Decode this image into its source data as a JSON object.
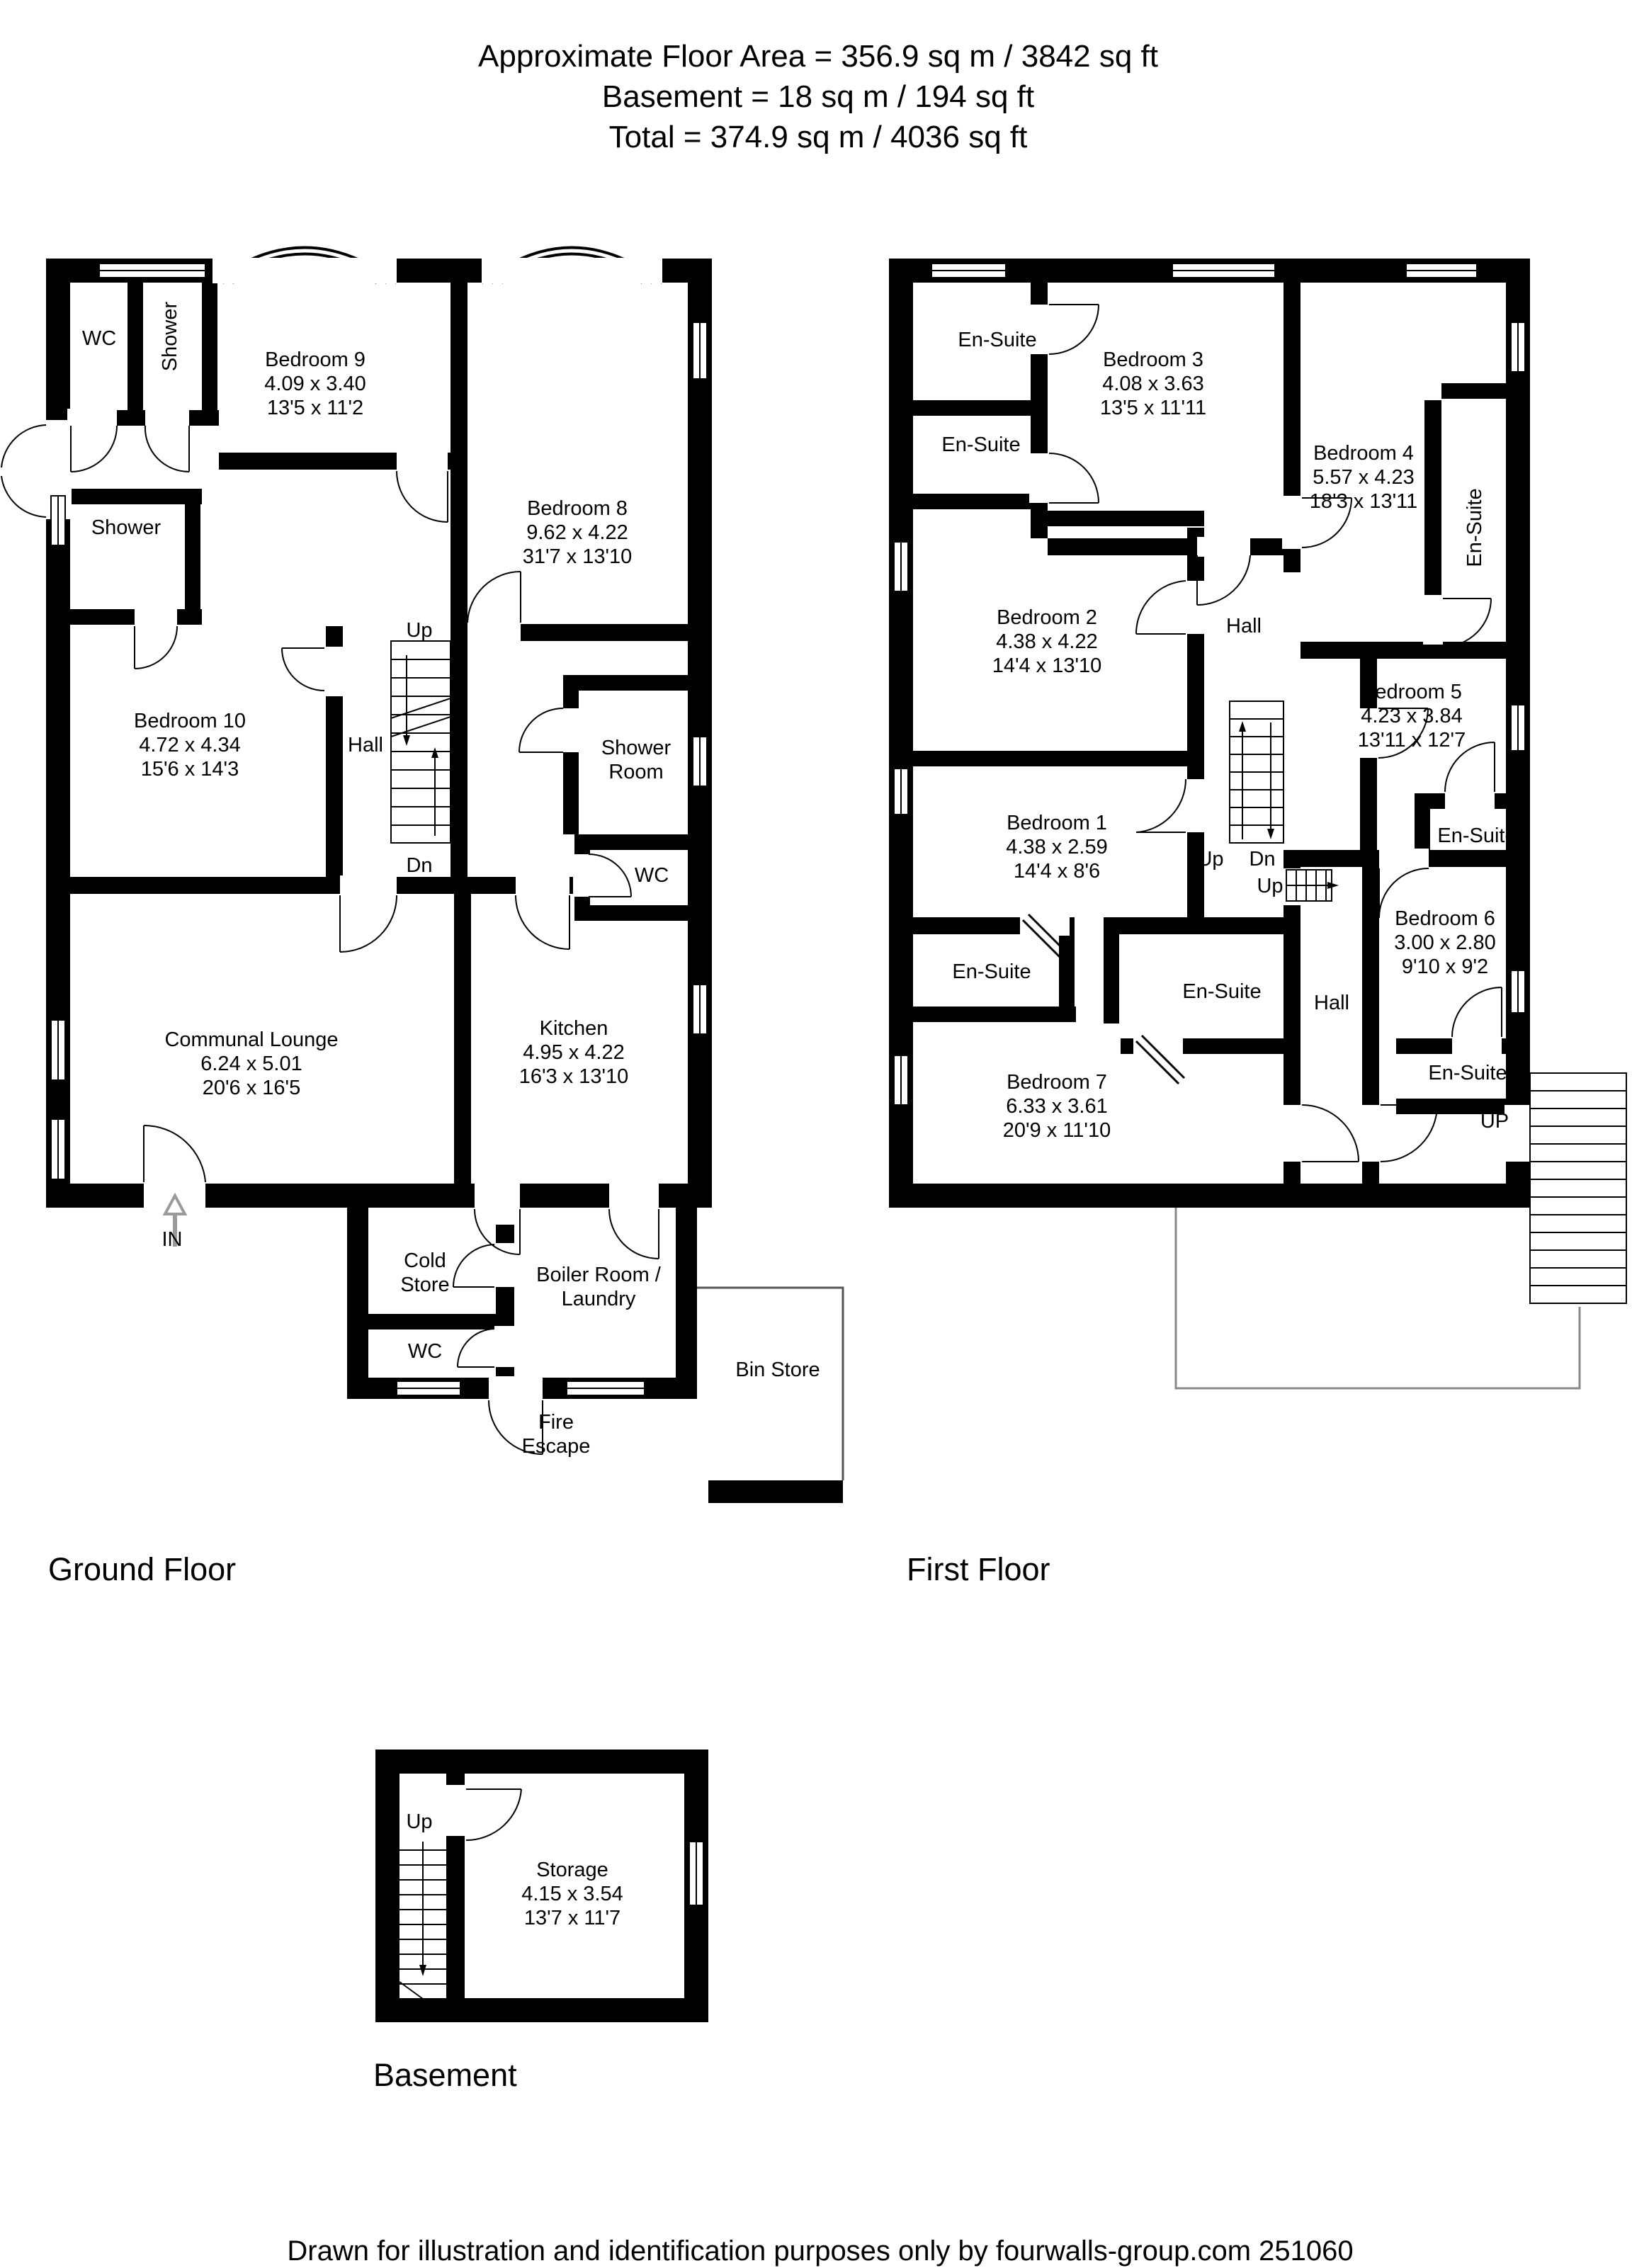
{
  "header": {
    "line1": "Approximate Floor Area = 356.9 sq m / 3842 sq ft",
    "line2": "Basement = 18 sq m / 194 sq ft",
    "line3": "Total = 374.9 sq m / 4036 sq ft"
  },
  "floors": {
    "ground": {
      "label": "Ground Floor",
      "rooms": {
        "wc_top": {
          "name": "WC"
        },
        "shower_top": {
          "name": "Shower"
        },
        "bedroom9": {
          "name": "Bedroom 9",
          "metric": "4.09 x 3.40",
          "imperial": "13'5 x 11'2"
        },
        "bedroom8": {
          "name": "Bedroom 8",
          "metric": "9.62 x 4.22",
          "imperial": "31'7 x 13'10"
        },
        "shower_mid": {
          "name": "Shower"
        },
        "bedroom10": {
          "name": "Bedroom 10",
          "metric": "4.72 x 4.34",
          "imperial": "15'6 x 14'3"
        },
        "hall": {
          "name": "Hall"
        },
        "shower_room": {
          "line1": "Shower",
          "line2": "Room"
        },
        "wc_right": {
          "name": "WC"
        },
        "communal_lounge": {
          "name": "Communal Lounge",
          "metric": "6.24 x 5.01",
          "imperial": "20'6 x 16'5"
        },
        "kitchen": {
          "name": "Kitchen",
          "metric": "4.95 x 4.22",
          "imperial": "16'3 x 13'10"
        },
        "cold_store": {
          "line1": "Cold",
          "line2": "Store"
        },
        "wc_bottom": {
          "name": "WC"
        },
        "boiler": {
          "line1": "Boiler Room /",
          "line2": "Laundry"
        },
        "bin_store": {
          "name": "Bin Store"
        },
        "fire_escape": {
          "line1": "Fire",
          "line2": "Escape"
        }
      },
      "annotations": {
        "up": "Up",
        "dn": "Dn",
        "entrance": "IN"
      }
    },
    "first": {
      "label": "First Floor",
      "rooms": {
        "ensuite_top1": {
          "name": "En-Suite"
        },
        "ensuite_top2": {
          "name": "En-Suite"
        },
        "bedroom3": {
          "name": "Bedroom 3",
          "metric": "4.08 x 3.63",
          "imperial": "13'5 x 11'11"
        },
        "bedroom4": {
          "name": "Bedroom 4",
          "metric": "5.57 x 4.23",
          "imperial": "18'3 x 13'11"
        },
        "ensuite_b4": {
          "name": "En-Suite"
        },
        "bedroom2": {
          "name": "Bedroom 2",
          "metric": "4.38 x 4.22",
          "imperial": "14'4 x 13'10"
        },
        "hall_upper": {
          "name": "Hall"
        },
        "bedroom5": {
          "name": "Bedroom 5",
          "metric": "4.23 x 3.84",
          "imperial": "13'11 x 12'7"
        },
        "ensuite_b5": {
          "name": "En-Suite"
        },
        "bedroom1": {
          "name": "Bedroom 1",
          "metric": "4.38 x 2.59",
          "imperial": "14'4 x 8'6"
        },
        "ensuite_b1": {
          "name": "En-Suite"
        },
        "ensuite_b7": {
          "name": "En-Suite"
        },
        "hall_lower": {
          "name": "Hall"
        },
        "bedroom6": {
          "name": "Bedroom 6",
          "metric": "3.00 x 2.80",
          "imperial": "9'10 x 9'2"
        },
        "ensuite_b6": {
          "name": "En-Suite"
        },
        "bedroom7": {
          "name": "Bedroom 7",
          "metric": "6.33 x 3.61",
          "imperial": "20'9 x 11'10"
        }
      },
      "annotations": {
        "up1": "Up",
        "dn": "Dn",
        "up2": "Up",
        "up_external": "UP"
      }
    },
    "basement": {
      "label": "Basement",
      "rooms": {
        "storage": {
          "name": "Storage",
          "metric": "4.15 x 3.54",
          "imperial": "13'7 x 11'7"
        }
      },
      "annotations": {
        "up": "Up"
      }
    }
  },
  "footer": {
    "credit": "Drawn for illustration and identification purposes only by fourwalls-group.com 251060"
  }
}
